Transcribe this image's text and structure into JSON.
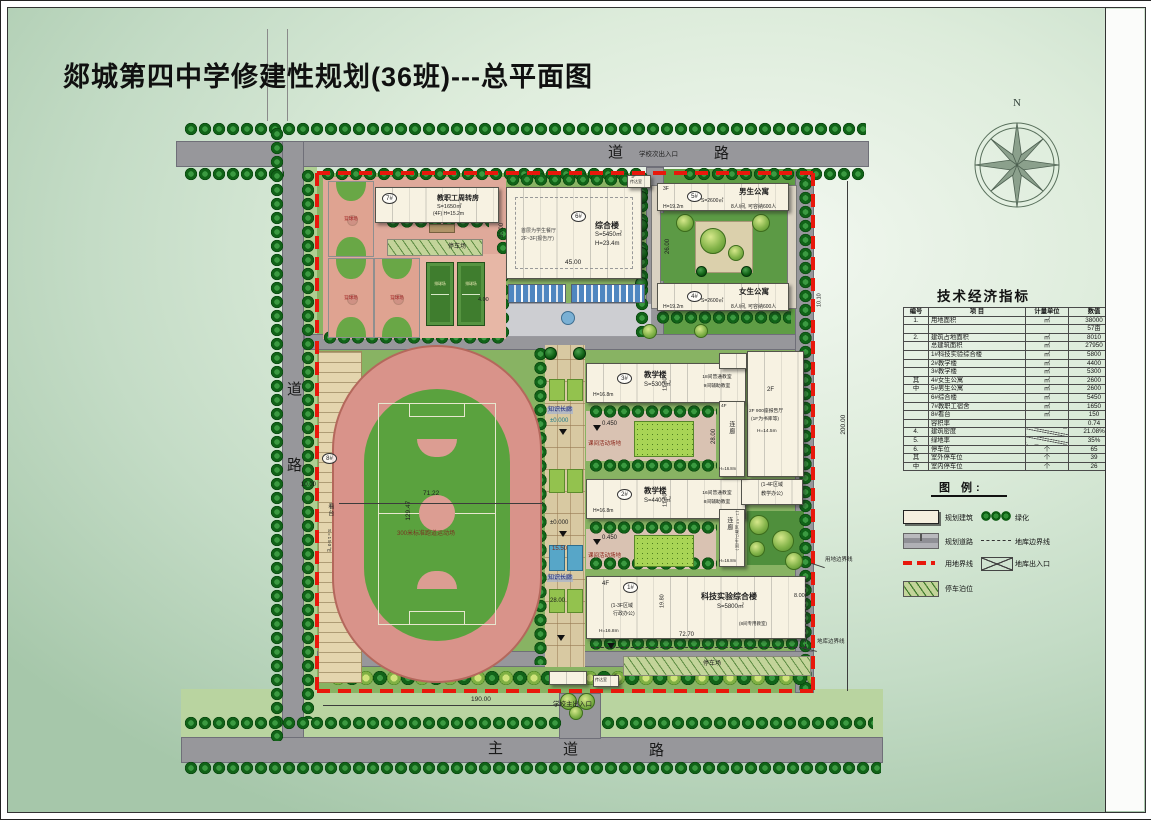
{
  "title": "郯城第四中学修建性规划(36班)---总平面图",
  "compass_n": "N",
  "roads": {
    "top_a": "道",
    "top_b": "路",
    "left_a": "道",
    "left_b": "路",
    "bottom_a": "主",
    "bottom_b": "道",
    "bottom_c": "路",
    "entry_secondary": "学校次出入口",
    "entry_main": "学校主出入口"
  },
  "table": {
    "title": "技术经济指标",
    "headers": [
      "编号",
      "项  目",
      "计量单位",
      "数值"
    ],
    "rows": [
      [
        "1.",
        "用地面积",
        "㎡",
        "38000"
      ],
      [
        "",
        "",
        "",
        "57亩"
      ],
      [
        "2.",
        "建筑占地面积",
        "㎡",
        "8010"
      ],
      [
        "",
        "总建筑面积",
        "㎡",
        "27950"
      ],
      [
        "",
        "1#科技实验综合楼",
        "㎡",
        "5800"
      ],
      [
        "",
        "2#教学楼",
        "㎡",
        "4400"
      ],
      [
        "",
        "3#教学楼",
        "㎡",
        "5300"
      ],
      [
        "其",
        "4#女生公寓",
        "㎡",
        "2600"
      ],
      [
        "中",
        "5#男生公寓",
        "㎡",
        "2600"
      ],
      [
        "",
        "6#综合楼",
        "㎡",
        "5450"
      ],
      [
        "",
        "7#教职工宿舍",
        "㎡",
        "1650"
      ],
      [
        "",
        "8#看台",
        "㎡",
        "150"
      ],
      [
        "",
        "容积率",
        "",
        "0.74"
      ],
      [
        "4.",
        "建筑密度",
        "/",
        "21.08%"
      ],
      [
        "5.",
        "绿地率",
        "/",
        "35%"
      ],
      [
        "6.",
        "停车位",
        "个",
        "65"
      ],
      [
        "其",
        "室外停车位",
        "个",
        "39"
      ],
      [
        "中",
        "室内停车位",
        "个",
        "26"
      ]
    ]
  },
  "legend": {
    "title": "图 例:",
    "items": [
      {
        "icon": "building-swatch",
        "label": "规划建筑"
      },
      {
        "icon": "greenery-swatch",
        "label": "绿化"
      },
      {
        "icon": "road-swatch",
        "label": "规划道路"
      },
      {
        "icon": "garage-boundary-swatch",
        "label": "地库边界线"
      },
      {
        "icon": "site-boundary-swatch",
        "label": "用地界线"
      },
      {
        "icon": "garage-entrance-swatch",
        "label": "地库出入口"
      },
      {
        "icon": "parking-swatch",
        "label": "停车泊位"
      }
    ]
  },
  "plan": {
    "b7": {
      "num": "7#",
      "name": "教职工周转房",
      "area": "S=1650㎡",
      "spec": "(4F) H=15.2m"
    },
    "b6": {
      "num": "6#",
      "name": "综合楼",
      "area": "S=5450㎡",
      "height": "H=23.4m",
      "note1": "首层为学生餐厅",
      "note2": "2F~3F(报告厅)"
    },
    "b5": {
      "num": "5#",
      "name": "男生公寓",
      "area": "S=2600㎡",
      "cap": "8人/间, 可容纳600人",
      "floors": "3F",
      "height": "H=19.2m"
    },
    "b4": {
      "num": "4#",
      "name": "女生公寓",
      "area": "S=2600㎡",
      "cap": "8人/间, 可容纳600人",
      "height": "H=19.2m"
    },
    "b3": {
      "num": "3#",
      "name": "教学楼",
      "area": "S=5300㎡",
      "height": "H=16.8m",
      "rooms1": "18间普通教室",
      "rooms2": "9间辅助教室"
    },
    "b2": {
      "num": "2#",
      "name": "教学楼",
      "area": "S=4400㎡",
      "height": "H=16.8m",
      "rooms1": "16间普通教室",
      "rooms2": "8间辅助教室"
    },
    "b1": {
      "num": "1#",
      "name": "科技实验综合楼",
      "area": "S=5800㎡",
      "floors": "4F",
      "zone1": "(1-3F区域",
      "zone2": "行政办公)",
      "height": "H=16.8m",
      "rooms": "(8间专用教室)"
    },
    "east": {
      "f2": "2F",
      "hall1": "2F 900座报告厅",
      "hall2": "(1F为书库等)",
      "height": "H=14.5m",
      "office1": "(1-4F区域",
      "office2": "教学办公)"
    },
    "cor1": {
      "floors": "4F",
      "name": "连廊",
      "height": "H=16.8m"
    },
    "cor2": {
      "name": "连廊",
      "note": "(1-4F区域卫生间)",
      "height": "H=16.8m"
    },
    "stand": {
      "num": "8#",
      "name": "看台",
      "area": "S=150㎡"
    },
    "track": {
      "w": "71.22",
      "h": "129.47",
      "label": "300米标准跑道运动场"
    },
    "court_basketball": "篮球场",
    "court_volleyball": "排球场",
    "parking_top": "停车场",
    "parking_bottom": "停车场",
    "corridor": {
      "name": "知识长廊",
      "elev": "±0.000",
      "d1": "15.50",
      "d2": "28.00"
    },
    "yard": {
      "label": "课间活动场地",
      "elev": "0.450"
    },
    "gate": {
      "label": "传达室",
      "floor": "1F"
    },
    "dims": {
      "d190": "190.00",
      "d200": "200.00",
      "d8": "8.00",
      "d26": "26.00",
      "d1010": "10.10",
      "d30": "30.00",
      "d45": "45.00",
      "d1160": "11.60",
      "d1980": "19.80",
      "d7270": "72.70",
      "d10": "10.00",
      "d4": "4.00"
    },
    "leaders": {
      "site": "用地边界线",
      "garage": "地库边界线"
    }
  }
}
